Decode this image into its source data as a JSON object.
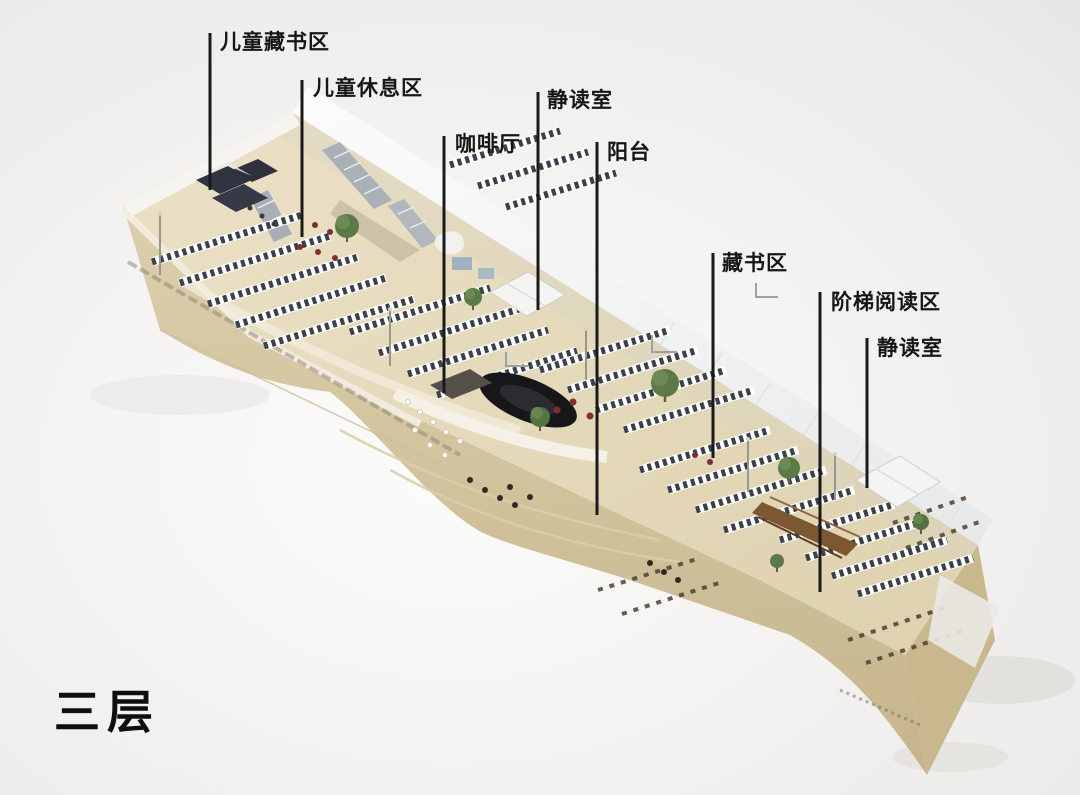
{
  "figure": {
    "floor_title": "三层",
    "callouts": [
      {
        "id": "children-books",
        "label": "儿童藏书区"
      },
      {
        "id": "children-rest",
        "label": "儿童休息区"
      },
      {
        "id": "quiet-room-left",
        "label": "静读室"
      },
      {
        "id": "cafe",
        "label": "咖啡厅"
      },
      {
        "id": "balcony",
        "label": "阳台"
      },
      {
        "id": "books",
        "label": "藏书区"
      },
      {
        "id": "stepped-reading",
        "label": "阶梯阅读区"
      },
      {
        "id": "quiet-room-right",
        "label": "静读室"
      }
    ],
    "colors": {
      "background": "#f2f1ef",
      "label_text": "#161616",
      "leader_line": "#1a1a1a",
      "building_floor": "#e7dcbe",
      "building_wall": "#d6c7a3",
      "glass": "#eef1f2",
      "shelf_dark": "#3c4149",
      "tree_green": "#5c7a47",
      "steps_brown": "#7d5632"
    }
  }
}
